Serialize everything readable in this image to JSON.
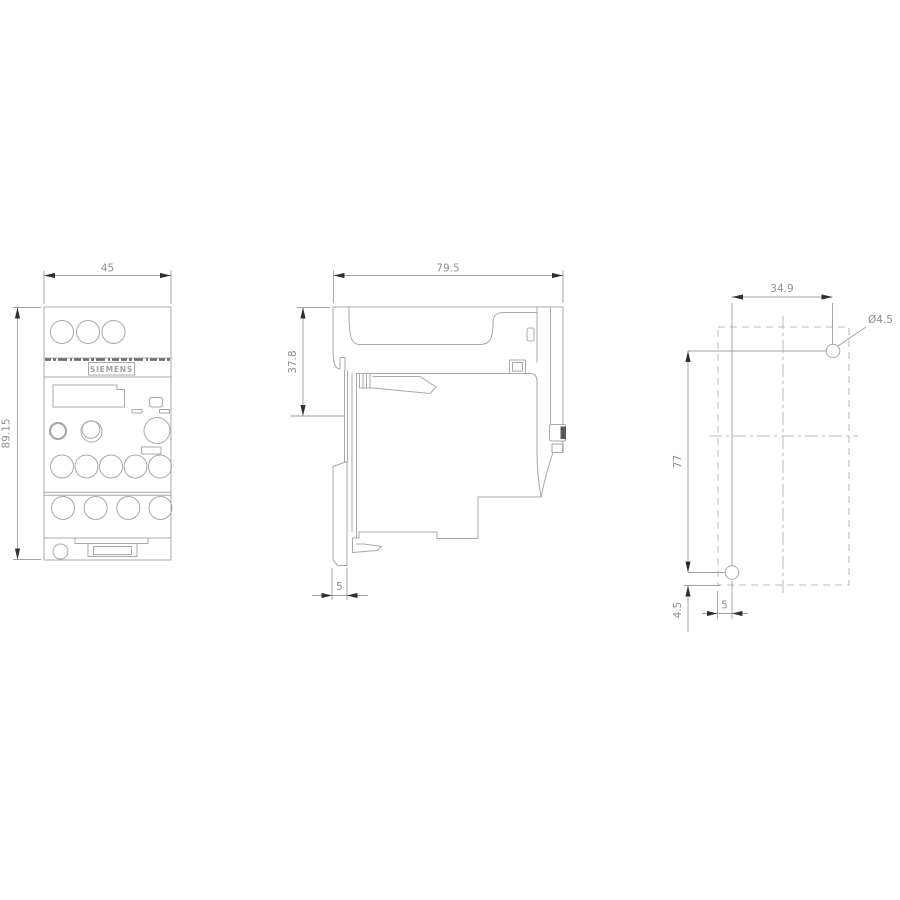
{
  "brand": "SIEMENS",
  "front_view": {
    "dim_width": "45",
    "dim_height": "89.15"
  },
  "side_view": {
    "dim_width": "79.5",
    "dim_depth_top": "37.8",
    "dim_rail_plate": "5"
  },
  "drill_plan": {
    "dim_hole_spacing_horizontal": "34.9",
    "dim_hole_diameter": "Ø4.5",
    "dim_hole_spacing_vertical": "77",
    "dim_bottom_offset": "4.5",
    "dim_left_offset": "5"
  },
  "colors": {
    "outline": "#a4a9ac",
    "dim": "#9aa0a5",
    "dimtext": "#8b9093",
    "arrow": "#2e3133",
    "dashline": "#b4b9bc",
    "band": "#6a7074",
    "screw": "#54585c",
    "background": "#ffffff"
  }
}
